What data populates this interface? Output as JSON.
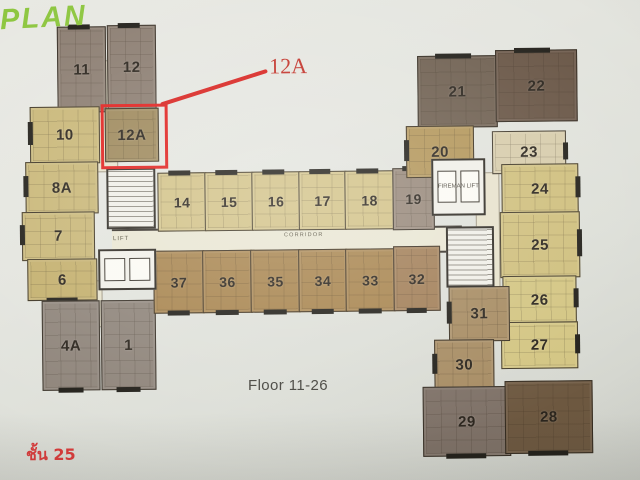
{
  "header": {
    "plan_logo": "PLAN"
  },
  "captions": {
    "floor_range": "Floor 11-26",
    "floor_thai": "ชั้น 25"
  },
  "annotation": {
    "label": "12A",
    "box_color": "#e0211e",
    "line_color": "#d8231f"
  },
  "plan": {
    "corridor_label": "CORRIDOR",
    "lift_label": "LIFT",
    "units": [
      {
        "label": "11",
        "x": 59,
        "y": 24,
        "w": 47,
        "h": 84,
        "color": "#8c7e72",
        "bar": "top"
      },
      {
        "label": "12",
        "x": 109,
        "y": 23,
        "w": 47,
        "h": 83,
        "color": "#8c7e72",
        "bar": "top"
      },
      {
        "label": "10",
        "x": 31,
        "y": 104,
        "w": 68,
        "h": 55,
        "color": "#c9b778",
        "bar": "left"
      },
      {
        "label": "12A",
        "x": 106,
        "y": 106,
        "w": 52,
        "h": 52,
        "color": "#9e895c"
      },
      {
        "label": "8A",
        "x": 26,
        "y": 159,
        "w": 71,
        "h": 50,
        "color": "#c9b778",
        "bar": "left"
      },
      {
        "label": "7",
        "x": 22,
        "y": 209,
        "w": 71,
        "h": 47,
        "color": "#c9b778",
        "bar": "left"
      },
      {
        "label": "6",
        "x": 27,
        "y": 256,
        "w": 68,
        "h": 40,
        "color": "#c4b06e",
        "bar": "bottom"
      },
      {
        "label": "4A",
        "x": 41,
        "y": 298,
        "w": 56,
        "h": 88,
        "color": "#8f857b",
        "bar": "bottom"
      },
      {
        "label": "1",
        "x": 100,
        "y": 298,
        "w": 53,
        "h": 88,
        "color": "#8f857b",
        "bar": "bottom"
      },
      {
        "label": "14",
        "x": 158,
        "y": 171,
        "w": 47,
        "h": 57,
        "color": "#d2c287",
        "bar": "top",
        "fs": 14
      },
      {
        "label": "15",
        "x": 205,
        "y": 171,
        "w": 47,
        "h": 57,
        "color": "#d2c287",
        "bar": "top",
        "fs": 14
      },
      {
        "label": "16",
        "x": 252,
        "y": 171,
        "w": 47,
        "h": 57,
        "color": "#d2c287",
        "bar": "top",
        "fs": 14
      },
      {
        "label": "17",
        "x": 299,
        "y": 171,
        "w": 46,
        "h": 57,
        "color": "#d2c287",
        "bar": "top",
        "fs": 14
      },
      {
        "label": "18",
        "x": 345,
        "y": 171,
        "w": 48,
        "h": 57,
        "color": "#d2c287",
        "bar": "top",
        "fs": 14
      },
      {
        "label": "19",
        "x": 393,
        "y": 169,
        "w": 40,
        "h": 60,
        "color": "#97887a",
        "bar": "top",
        "fs": 14
      },
      {
        "label": "37",
        "x": 153,
        "y": 249,
        "w": 49,
        "h": 61,
        "color": "#a8854f",
        "bar": "bottom",
        "fs": 14
      },
      {
        "label": "36",
        "x": 202,
        "y": 249,
        "w": 48,
        "h": 61,
        "color": "#a8854f",
        "bar": "bottom",
        "fs": 14
      },
      {
        "label": "35",
        "x": 250,
        "y": 249,
        "w": 48,
        "h": 61,
        "color": "#a8854f",
        "bar": "bottom",
        "fs": 14
      },
      {
        "label": "34",
        "x": 298,
        "y": 249,
        "w": 47,
        "h": 61,
        "color": "#a8854f",
        "bar": "bottom",
        "fs": 14
      },
      {
        "label": "33",
        "x": 345,
        "y": 249,
        "w": 48,
        "h": 61,
        "color": "#a8854f",
        "bar": "bottom",
        "fs": 14
      },
      {
        "label": "32",
        "x": 393,
        "y": 247,
        "w": 45,
        "h": 63,
        "color": "#a27f58",
        "bar": "bottom",
        "fs": 14
      },
      {
        "label": "21",
        "x": 419,
        "y": 57,
        "w": 78,
        "h": 70,
        "color": "#6f6051",
        "bar": "top"
      },
      {
        "label": "22",
        "x": 497,
        "y": 52,
        "w": 80,
        "h": 70,
        "color": "#695646",
        "bar": "top"
      },
      {
        "label": "20",
        "x": 407,
        "y": 127,
        "w": 66,
        "h": 50,
        "color": "#b3965a",
        "bar": "left"
      },
      {
        "label": "23",
        "x": 493,
        "y": 133,
        "w": 72,
        "h": 41,
        "color": "#d7ccab",
        "bar": "right"
      },
      {
        "label": "24",
        "x": 502,
        "y": 166,
        "w": 75,
        "h": 48,
        "color": "#cfbf7d",
        "bar": "right"
      },
      {
        "label": "25",
        "x": 500,
        "y": 214,
        "w": 78,
        "h": 64,
        "color": "#cfbf7d",
        "bar": "right"
      },
      {
        "label": "26",
        "x": 502,
        "y": 278,
        "w": 72,
        "h": 46,
        "color": "#d3c582",
        "bar": "right"
      },
      {
        "label": "27",
        "x": 500,
        "y": 324,
        "w": 75,
        "h": 45,
        "color": "#d3c582",
        "bar": "right"
      },
      {
        "label": "31",
        "x": 448,
        "y": 288,
        "w": 59,
        "h": 53,
        "color": "#a78c63",
        "bar": "left"
      },
      {
        "label": "30",
        "x": 433,
        "y": 341,
        "w": 58,
        "h": 49,
        "color": "#a78c63",
        "bar": "left"
      },
      {
        "label": "29",
        "x": 421,
        "y": 388,
        "w": 86,
        "h": 68,
        "color": "#7e7167",
        "bar": "bottom"
      },
      {
        "label": "28",
        "x": 503,
        "y": 383,
        "w": 86,
        "h": 71,
        "color": "#6d5840",
        "bar": "bottom"
      }
    ],
    "cores": [
      {
        "type": "stairs",
        "x": 107,
        "y": 166,
        "w": 45,
        "h": 57
      },
      {
        "type": "lifts",
        "x": 98,
        "y": 247,
        "w": 54,
        "h": 37
      },
      {
        "type": "lifts",
        "x": 432,
        "y": 160,
        "w": 50,
        "h": 53,
        "label": "FIREMAN LIFT"
      },
      {
        "type": "stairs",
        "x": 446,
        "y": 228,
        "w": 44,
        "h": 57
      }
    ],
    "spines": [
      {
        "x": 97,
        "y": 58,
        "w": 20,
        "h": 110
      },
      {
        "x": 85,
        "y": 278,
        "w": 15,
        "h": 45
      },
      {
        "x": 476,
        "y": 174,
        "w": 22,
        "h": 114
      }
    ]
  }
}
